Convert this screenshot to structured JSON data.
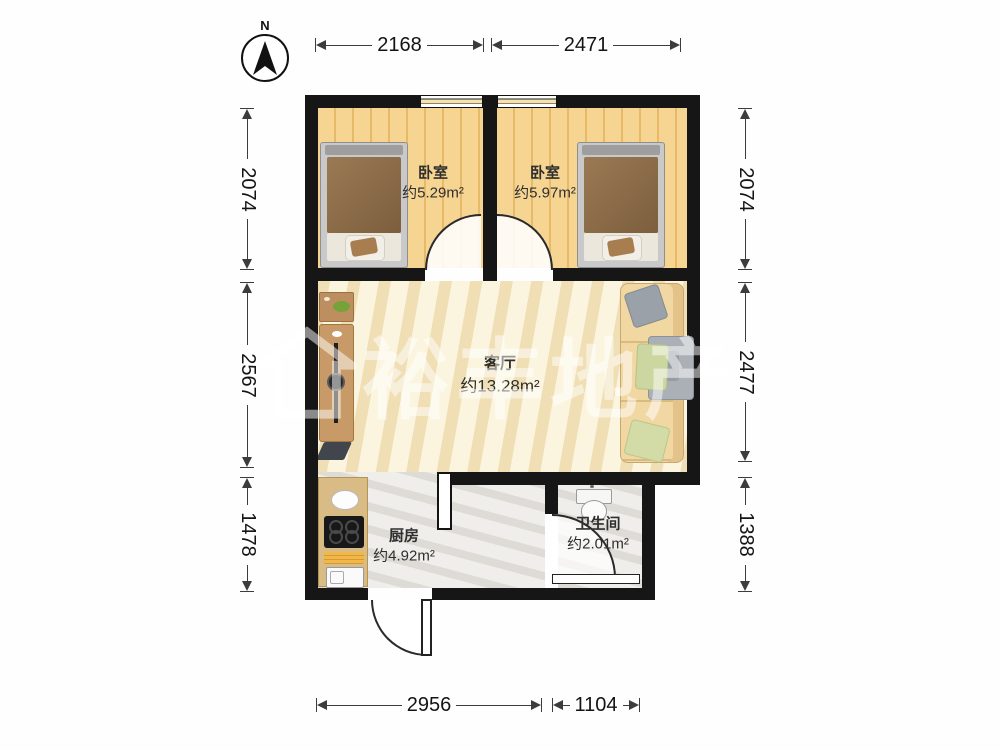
{
  "compass": {
    "label": "N"
  },
  "watermark": {
    "text": "裕丰地产"
  },
  "rooms": {
    "bedroom_left": {
      "name": "卧室",
      "area": "约5.29m²"
    },
    "bedroom_right": {
      "name": "卧室",
      "area": "约5.97m²"
    },
    "living": {
      "name": "客厅",
      "area": "约13.28m²"
    },
    "kitchen": {
      "name": "厨房",
      "area": "约4.92m²"
    },
    "bathroom": {
      "name": "卫生间",
      "area": "约2.01m²"
    }
  },
  "dimensions": {
    "top": [
      {
        "value": "2168"
      },
      {
        "value": "2471"
      }
    ],
    "left": [
      {
        "value": "2074"
      },
      {
        "value": "2567"
      },
      {
        "value": "1478"
      }
    ],
    "right": [
      {
        "value": "2074"
      },
      {
        "value": "2477"
      },
      {
        "value": "1388"
      }
    ],
    "bottom": [
      {
        "value": "2956"
      },
      {
        "value": "1104"
      }
    ]
  },
  "icons": {
    "compass": "north-arrow",
    "watermark_logo": "house-outline"
  },
  "colors": {
    "wall": "#161616",
    "wood_floor": "#f2cc82",
    "living_floor": "#f8eecf",
    "tile_floor": "#eae8e3",
    "counter": "#d9bb86",
    "sofa": "#f1d7a2",
    "plant": "#76a339"
  }
}
